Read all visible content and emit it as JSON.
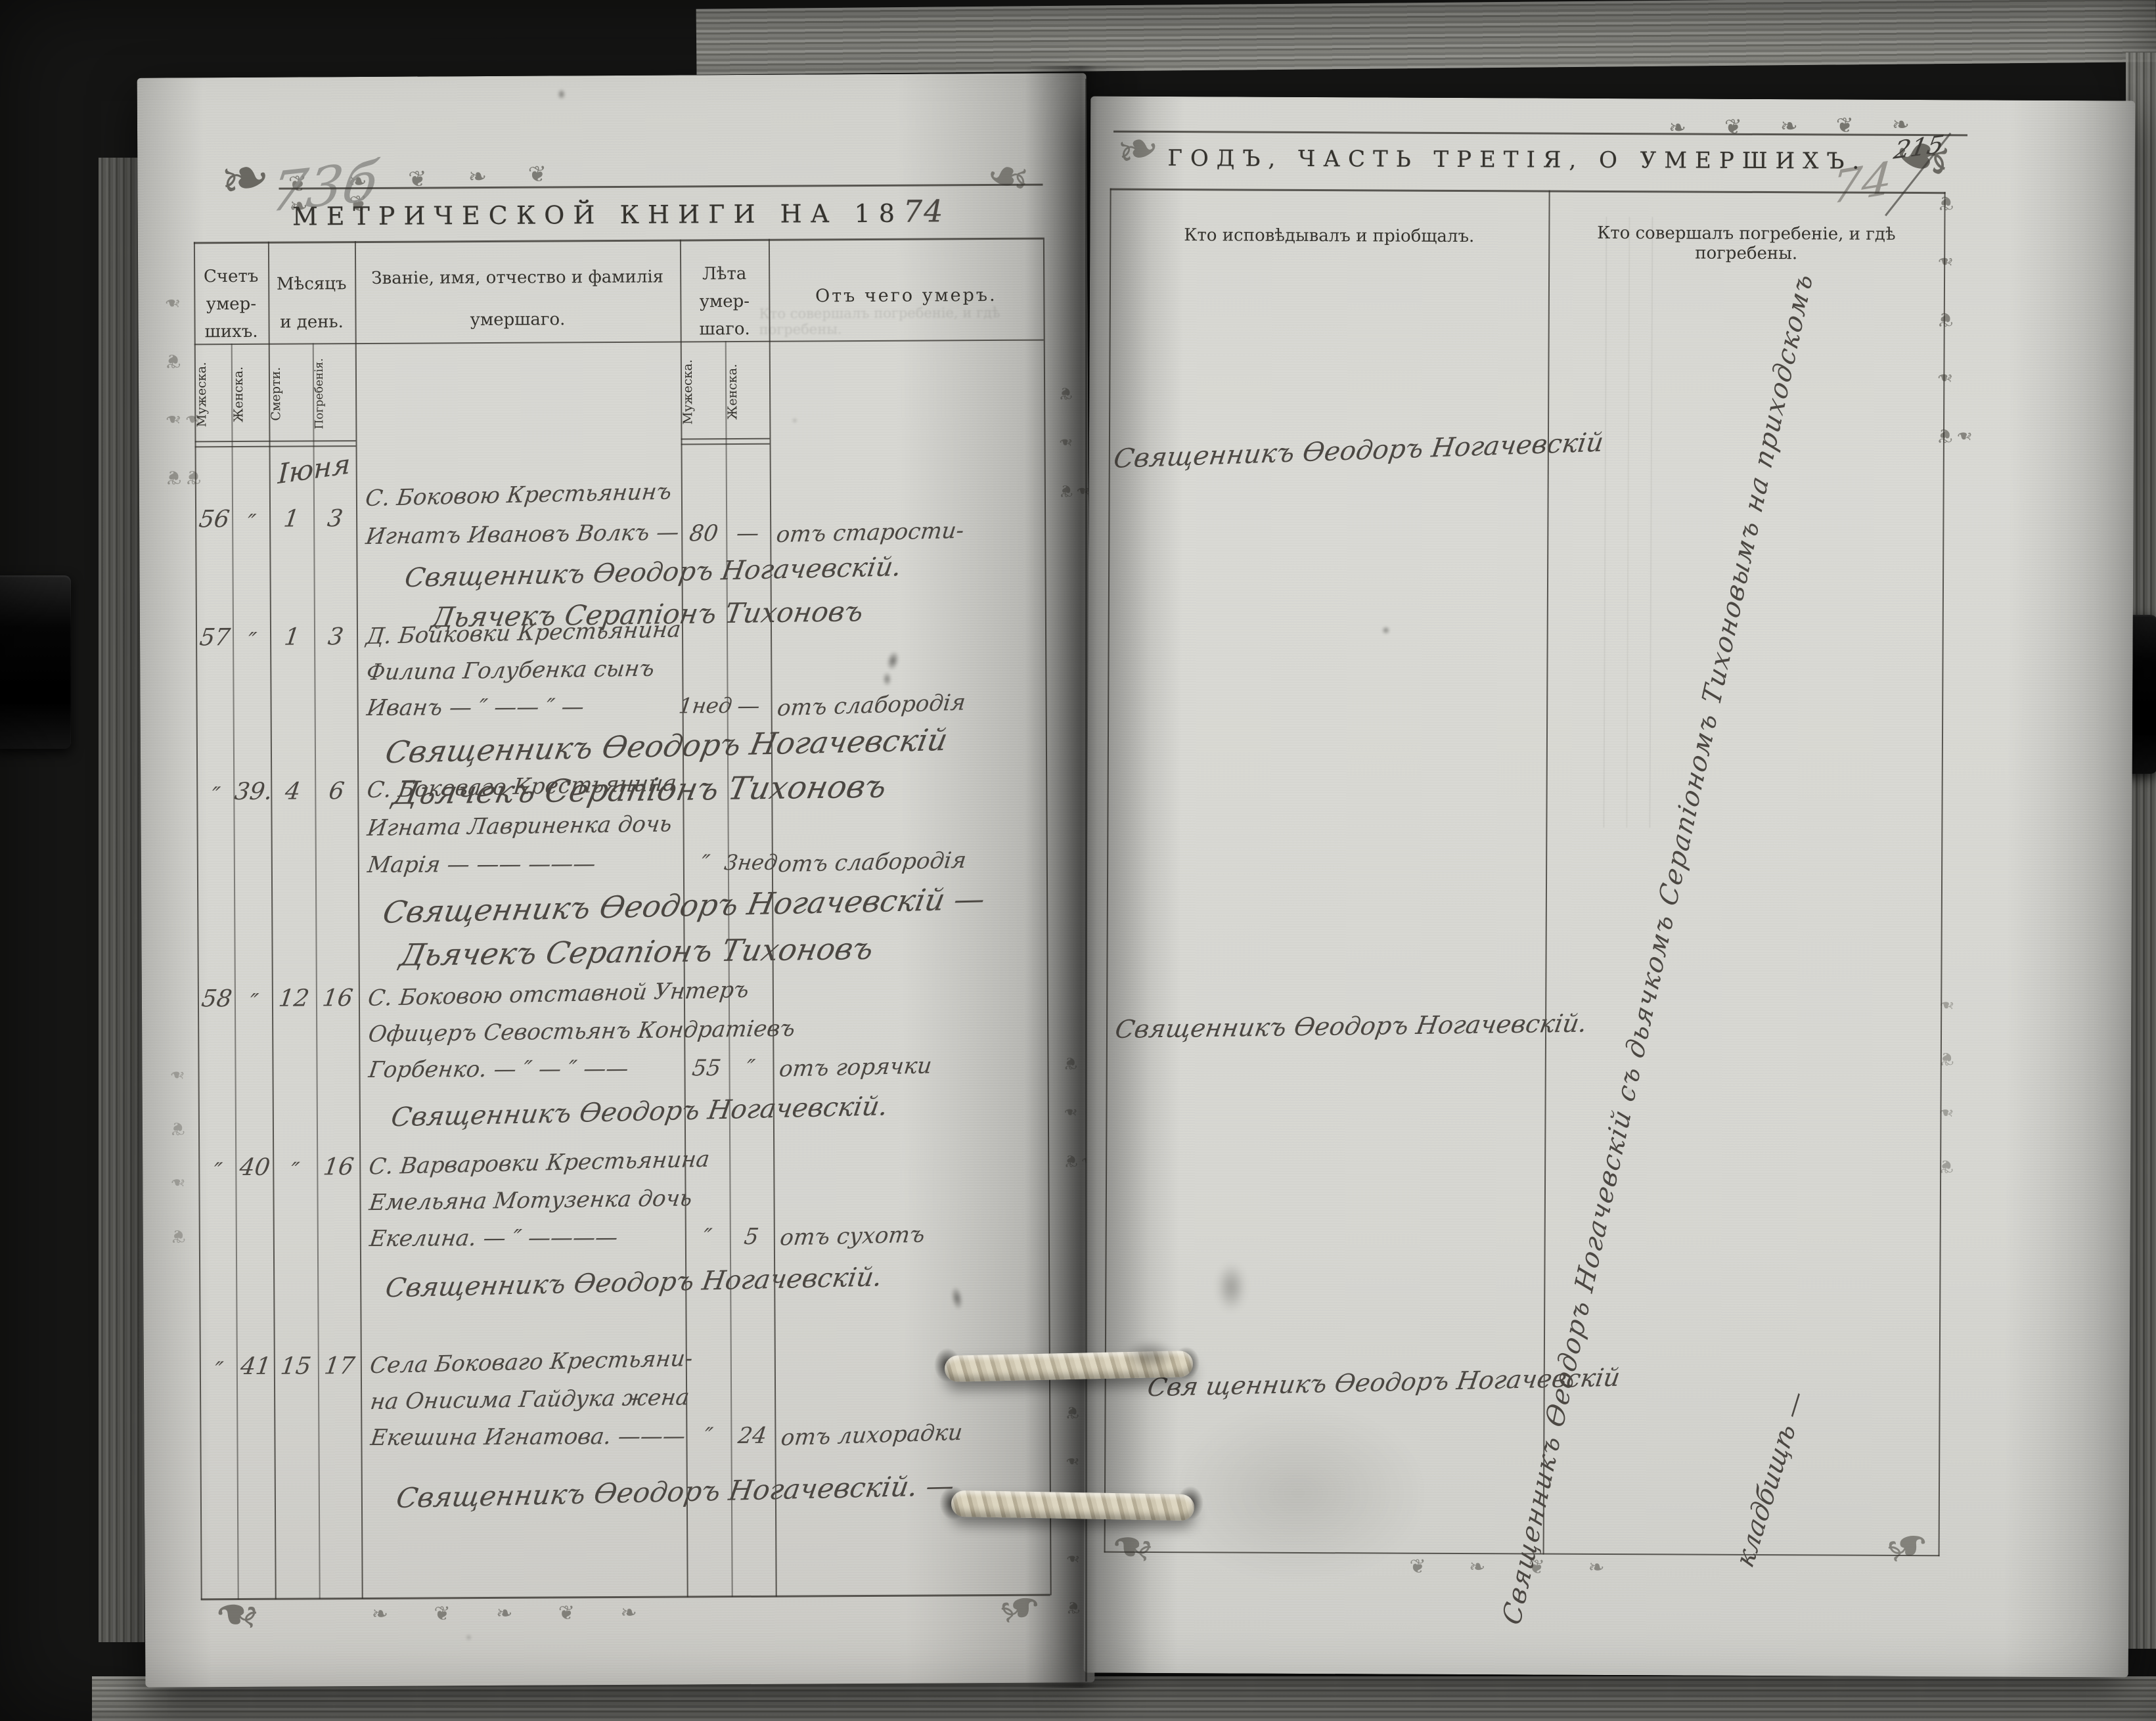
{
  "left_page": {
    "archive_mark_hw": "73б",
    "title_printed": "МЕТРИЧЕСКОЙ КНИГИ НА 18",
    "title_year_hw": "74",
    "month_hw": "Іюня",
    "table": {
      "col_count_lines": [
        "Счетъ",
        "умер-",
        "шихъ."
      ],
      "col_month_lines": [
        "Мѣсяцъ",
        "и день."
      ],
      "col_name_lines": [
        "Званіе, имя, отчество и фамилія",
        "умершаго."
      ],
      "col_age_lines": [
        "Лѣта",
        "умер-",
        "шаго."
      ],
      "col_cause": "Отъ чего умеръ.",
      "sub_male": "Мужеска.",
      "sub_female": "Женска.",
      "sub_death": "Смерти.",
      "sub_burial": "Погребенія."
    },
    "entries": [
      {
        "num_male": "56",
        "num_female": "″",
        "day_death": "1",
        "day_burial": "3",
        "lines": [
          "С. Боковою Крестьянинъ",
          "Игнатъ Ивановъ Волкъ —"
        ],
        "age_male": "80",
        "age_female": "—",
        "cause": "отъ старости-",
        "clergy": [
          "Священникъ Ѳеодоръ Ногачевскій.",
          "Дьячекъ Серапіонъ Тихоновъ"
        ]
      },
      {
        "num_male": "57",
        "num_female": "″",
        "day_death": "1",
        "day_burial": "3",
        "lines": [
          "Д. Бойковки Крестьянина",
          "Филипа Голубенка сынъ",
          "Иванъ — ″ —— ″ —"
        ],
        "age_male": "1нед",
        "age_female": "—",
        "cause": "отъ слабородія",
        "clergy": [
          "Священникъ Ѳеодоръ Ногачевскій",
          "Дьячекъ Серапіонъ Тихоновъ"
        ]
      },
      {
        "num_male": "″",
        "num_female": "39.",
        "day_death": "4",
        "day_burial": "6",
        "lines": [
          "С. Боковаго Крестьянина",
          "Игната Лавриненка дочь",
          "Марія — —— ———"
        ],
        "age_male": "″",
        "age_female": "3нед",
        "cause": "отъ слабородія",
        "clergy": [
          "Священникъ Ѳеодоръ Ногачевскій —",
          "Дьячекъ Серапіонъ Тихоновъ"
        ]
      },
      {
        "num_male": "58",
        "num_female": "″",
        "day_death": "12",
        "day_burial": "16",
        "lines": [
          "С. Боковою отставной Унтеръ",
          "Офицеръ Севостьянъ Кондратіевъ",
          "Горбенко. — ″ — ″ ——"
        ],
        "age_male": "55",
        "age_female": "″",
        "cause": "отъ горячки",
        "clergy": [
          "Священникъ Ѳеодоръ Ногачевскій."
        ]
      },
      {
        "num_male": "″",
        "num_female": "40",
        "day_death": "″",
        "day_burial": "16",
        "lines": [
          "С. Варваровки Крестьянина",
          "Емельяна Мотузенка дочь",
          "Екелина. — ″ ————"
        ],
        "age_male": "″",
        "age_female": "5",
        "cause": "отъ сухотъ",
        "clergy": [
          "Священникъ Ѳеодоръ Ногачевскій."
        ]
      },
      {
        "num_male": "″",
        "num_female": "41",
        "day_death": "15",
        "day_burial": "17",
        "lines": [
          "Села Боковаго Крестьяни-",
          "на Онисима Гайдука жена",
          "Екешина Игнатова. ———"
        ],
        "age_male": "″",
        "age_female": "24",
        "cause": "отъ лихорадки",
        "clergy": [
          "Священникъ Ѳеодоръ Ногачевскій. —"
        ]
      }
    ]
  },
  "right_page": {
    "header_printed": "ГОДЪ, ЧАСТЬ ТРЕТІЯ, О УМЕРШИХЪ.",
    "page_number_ink": "215",
    "page_number_pencil": "74",
    "col_confessed": "Кто исповѣдывалъ и пріобщалъ.",
    "col_burial": "Кто совершалъ погребеніе, и гдѣ погребены.",
    "entries_hw": [
      "Священникъ Ѳеодоръ Ногачевскій",
      "Священникъ Ѳеодоръ Ногачевскій.",
      "Свя щенникъ Ѳеодоръ Ногачевскій"
    ],
    "burial_note_diagonal_hw": "Священникъ Ѳеодоръ Ногачевскій съ дьячкомъ Серапіономъ Тихоновымъ на приходскомъ",
    "burial_note_tail_hw": "кладбищѣ —"
  },
  "decor": {
    "corner": "❧",
    "floral": "❦",
    "chain7": "❦ ❧ ❦ ❧ ❦ ❧ ❦",
    "chain5": "❧ ❦ ❧ ❦ ❧",
    "chain4": "❦ ❧ ❦ ❧",
    "vchain4": "❦ ❧ ❦ ❧",
    "vchain6": "❦ ❧ ❦ ❧ ❦ ❧"
  }
}
